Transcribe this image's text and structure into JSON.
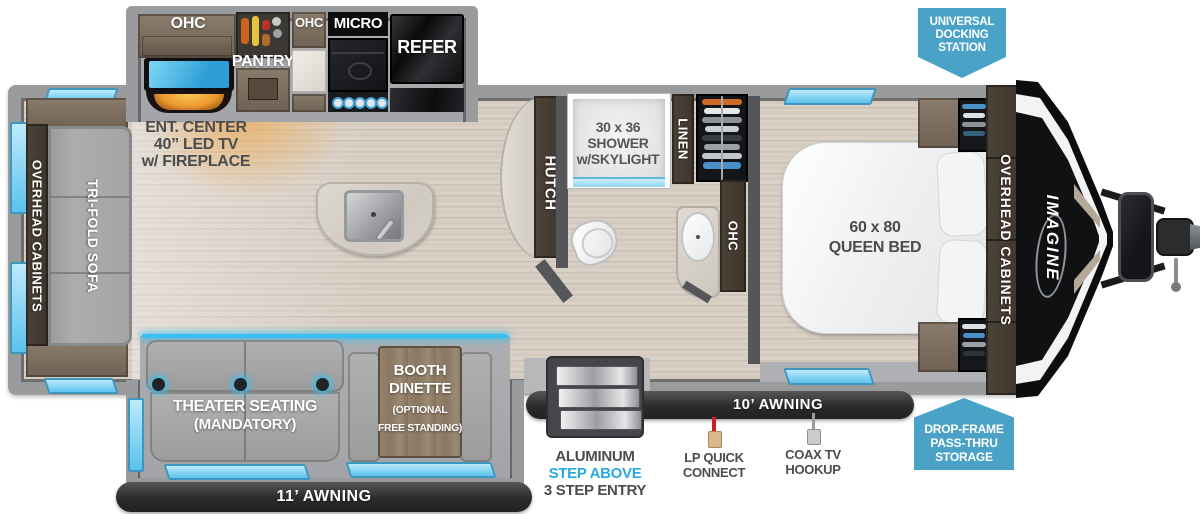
{
  "colors": {
    "badge_blue": "#4aa2c6",
    "step_above_blue": "#29a9e1",
    "label_gray": "#4b4c4e",
    "window_blue": "#5cc2ec",
    "wall_gray": "#9a9b9d",
    "dark_wall": "#55565a",
    "fireplace_orange": "#eda43c",
    "tv_screen_blue": "#5ec7ef"
  },
  "kitchen": {
    "ohc_left": "OHC",
    "pantry": "PANTRY",
    "ohc_mid": "OHC",
    "micro": "MICRO",
    "refer": "REFER",
    "ent_l1": "ENT. CENTER",
    "ent_l2": "40” LED TV",
    "ent_l3": "w/ FIREPLACE"
  },
  "bathroom": {
    "shower_l1": "30 x 36",
    "shower_l2": "SHOWER",
    "shower_l3": "w/SKYLIGHT",
    "linen": "LINEN",
    "ohc": "OHC"
  },
  "bedroom": {
    "bed_l1": "60 x 80",
    "bed_l2": "QUEEN BED",
    "overhead_cabinets": "OVERHEAD CABINETS"
  },
  "rear": {
    "overhead_cabinets": "OVERHEAD CABINETS",
    "sofa": "TRI-FOLD SOFA"
  },
  "living": {
    "hutch": "HUTCH",
    "theater_l1": "THEATER SEATING",
    "theater_l2": "(MANDATORY)",
    "booth_l1": "BOOTH",
    "booth_l2": "DINETTE",
    "booth_l3": "(OPTIONAL",
    "booth_l4": "FREE STANDING)"
  },
  "exterior": {
    "brand": "IMAGINE",
    "awning_10": "10’ AWNING",
    "awning_11": "11’ AWNING",
    "step_l1": "ALUMINUM",
    "step_l2": "STEP ABOVE",
    "step_l3": "3 STEP ENTRY",
    "lp_l1": "LP QUICK",
    "lp_l2": "CONNECT",
    "coax_l1": "COAX TV",
    "coax_l2": "HOOKUP"
  },
  "badges": {
    "docking_l1": "UNIVERSAL",
    "docking_l2": "DOCKING",
    "docking_l3": "STATION",
    "storage_l1": "DROP-FRAME",
    "storage_l2": "PASS-THRU",
    "storage_l3": "STORAGE"
  }
}
